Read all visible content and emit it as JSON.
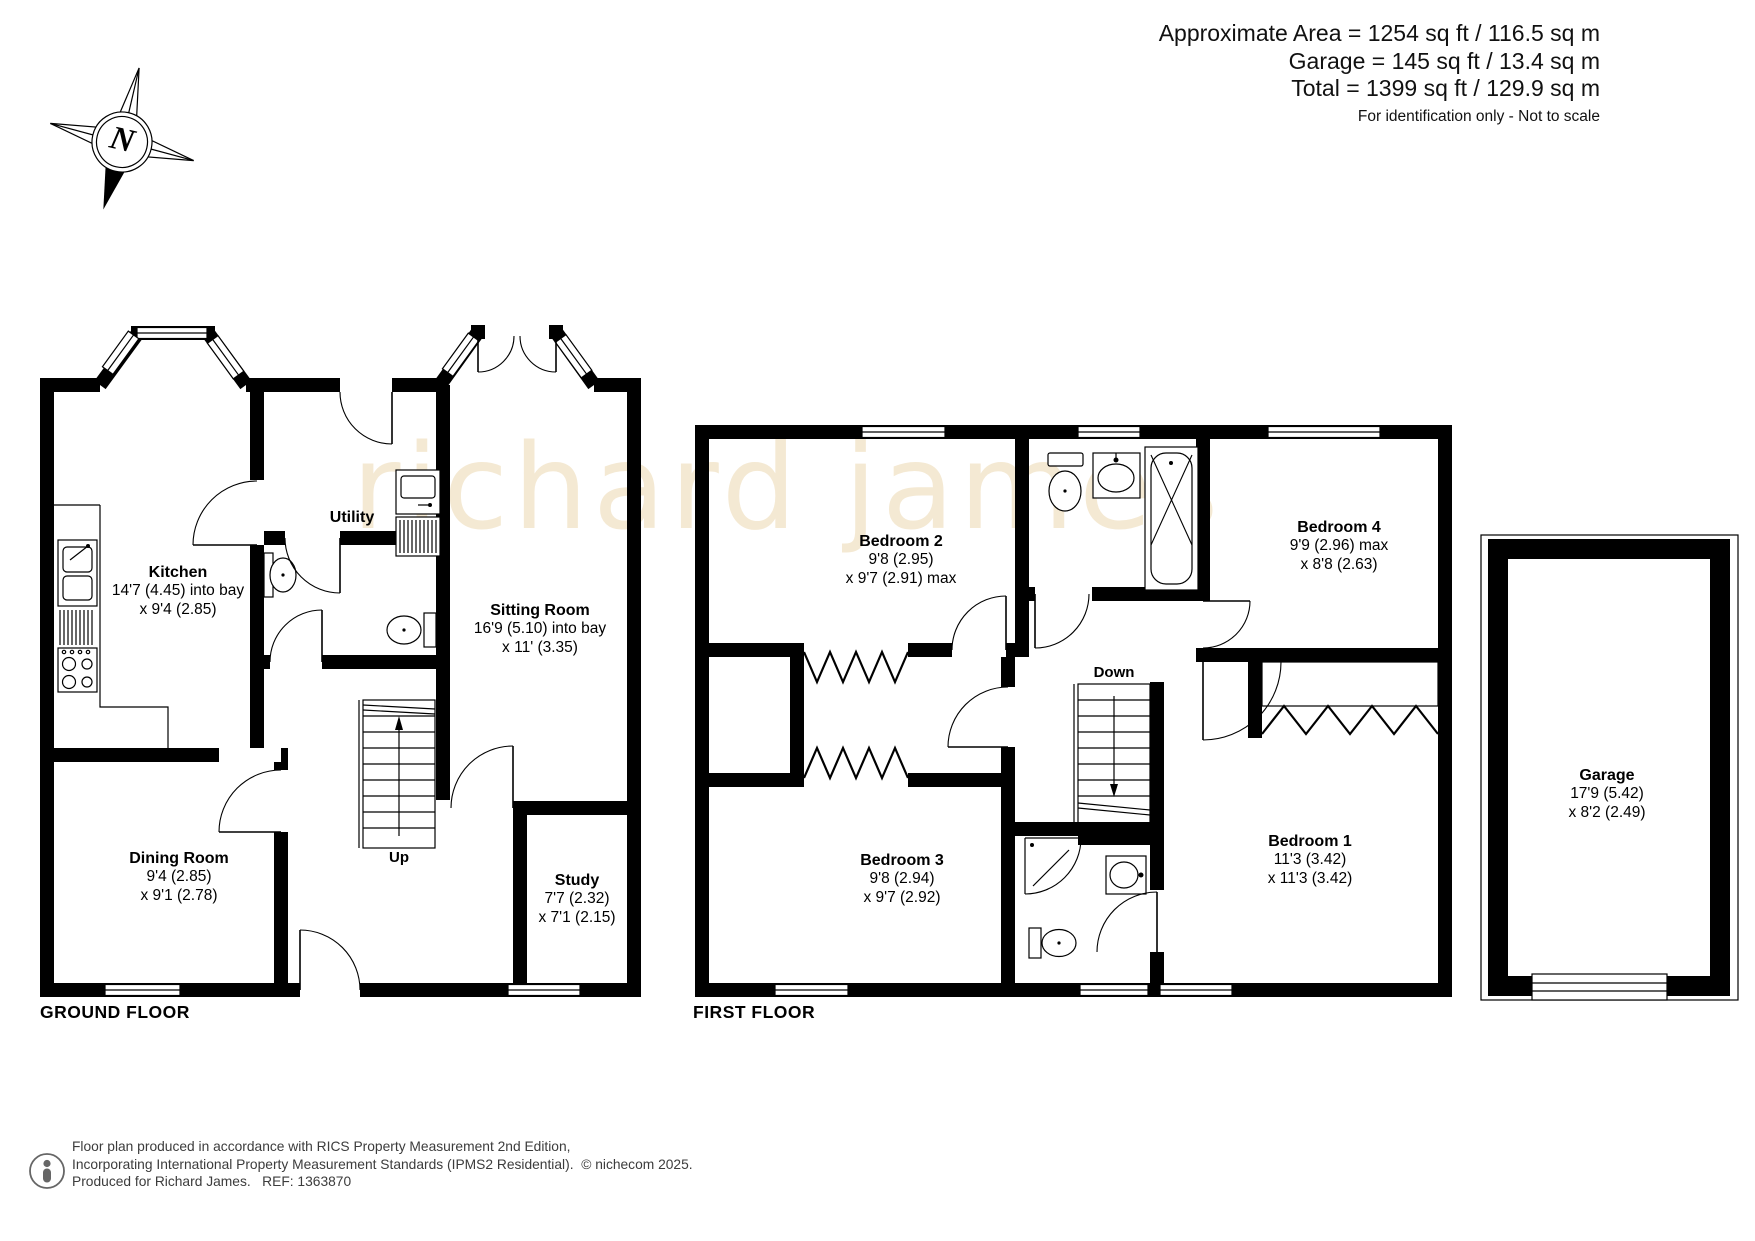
{
  "header": {
    "line1": "Approximate Area = 1254 sq ft / 116.5 sq m",
    "line2": "Garage = 145 sq ft / 13.4 sq m",
    "line3": "Total = 1399 sq ft / 129.9 sq m",
    "note": "For identification only - Not to scale"
  },
  "compass": {
    "label": "N"
  },
  "watermark": {
    "text": "richard james"
  },
  "ground": {
    "title": "GROUND FLOOR",
    "kitchen": {
      "name": "Kitchen",
      "l1": "14'7 (4.45) into bay",
      "l2": "x 9'4 (2.85)"
    },
    "utility": {
      "name": "Utility"
    },
    "sitting": {
      "name": "Sitting Room",
      "l1": "16'9 (5.10) into bay",
      "l2": "x 11' (3.35)"
    },
    "dining": {
      "name": "Dining Room",
      "l1": "9'4 (2.85)",
      "l2": "x 9'1 (2.78)"
    },
    "study": {
      "name": "Study",
      "l1": "7'7 (2.32)",
      "l2": "x 7'1 (2.15)"
    },
    "stairs": {
      "label": "Up"
    }
  },
  "first": {
    "title": "FIRST FLOOR",
    "bedroom2": {
      "name": "Bedroom 2",
      "l1": "9'8 (2.95)",
      "l2": "x 9'7 (2.91) max"
    },
    "bedroom4": {
      "name": "Bedroom 4",
      "l1": "9'9 (2.96) max",
      "l2": "x 8'8 (2.63)"
    },
    "bedroom3": {
      "name": "Bedroom 3",
      "l1": "9'8 (2.94)",
      "l2": "x 9'7 (2.92)"
    },
    "bedroom1": {
      "name": "Bedroom 1",
      "l1": "11'3 (3.42)",
      "l2": "x 11'3 (3.42)"
    },
    "stairs": {
      "label": "Down"
    }
  },
  "garage": {
    "name": "Garage",
    "l1": "17'9 (5.42)",
    "l2": "x 8'2 (2.49)"
  },
  "footer": {
    "line1": "Floor plan produced in accordance with RICS Property Measurement 2nd Edition,",
    "line2": "Incorporating International Property Measurement Standards (IPMS2 Residential).  © nichecom 2025.",
    "line3": "Produced for Richard James.   REF: 1363870"
  },
  "colors": {
    "wall": "#000000",
    "watermark": "#e8cf9e"
  }
}
